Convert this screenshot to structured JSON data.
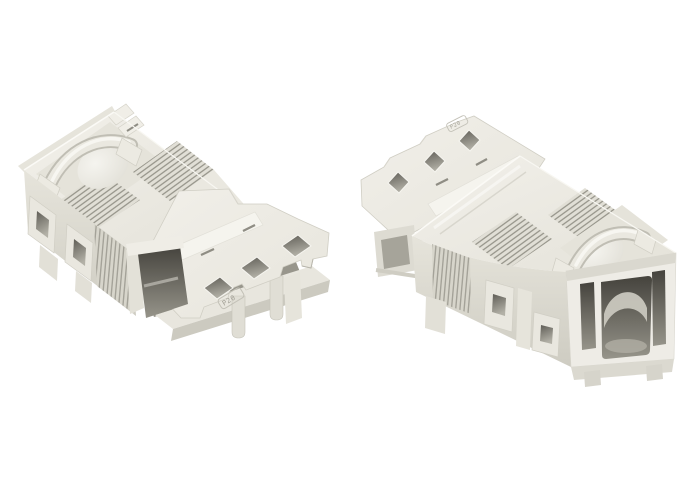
{
  "page": {
    "background": "#ffffff"
  },
  "products": {
    "left": {
      "marking": "P20",
      "description": "White 2-pole snap-in plug connector, angled view showing strain-relief top and mounting flange"
    },
    "right": {
      "marking": "P20",
      "description": "White 2-pole snap-in socket connector, angled view showing mounting flange and open mating face"
    }
  },
  "palette": {
    "body": "#edebe4",
    "shade": "#d6d4ca",
    "rib_line": "#a3a197",
    "hatch_line": "#8e8c82",
    "cavity_dark": "#4e4c45",
    "highlight": "#f8f7f2"
  }
}
